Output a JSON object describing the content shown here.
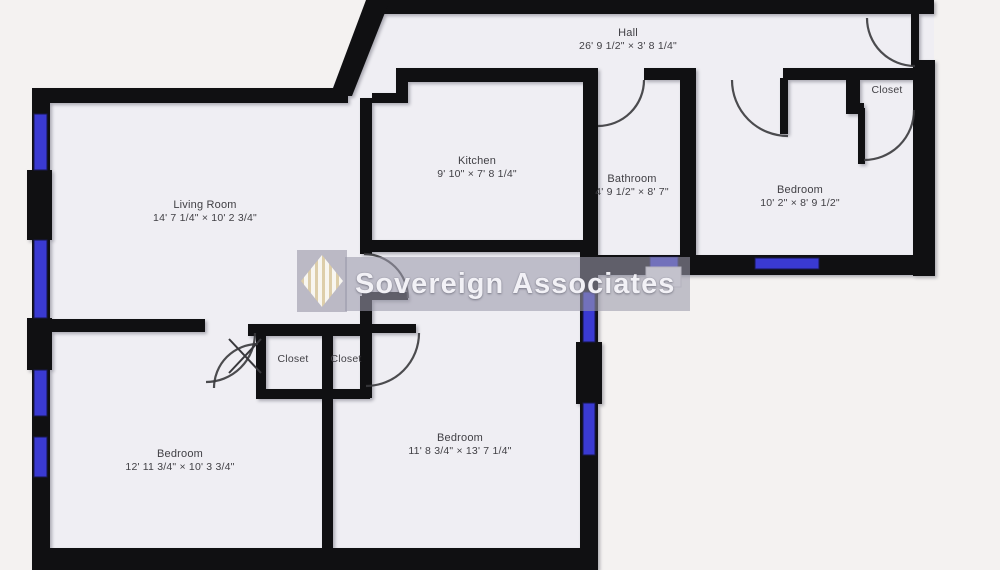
{
  "watermark": {
    "text": "Sovereign Associates",
    "logo_icon": "striped-diamond-logo"
  },
  "rooms": {
    "hall": {
      "name": "Hall",
      "dims": "26' 9 1/2\" × 3' 8 1/4\""
    },
    "kitchen": {
      "name": "Kitchen",
      "dims": "9' 10\" × 7' 8 1/4\""
    },
    "living_room": {
      "name": "Living Room",
      "dims": "14' 7 1/4\" × 10' 2 3/4\""
    },
    "bathroom": {
      "name": "Bathroom",
      "dims": "4' 9 1/2\" × 8' 7\""
    },
    "bedroom_ne": {
      "name": "Bedroom",
      "dims": "10' 2\" × 8' 9 1/2\""
    },
    "closet_ne": {
      "name": "Closet"
    },
    "closet_west": {
      "name": "Closet"
    },
    "closet_east": {
      "name": "Closet"
    },
    "bedroom_sw": {
      "name": "Bedroom",
      "dims": "12' 11 3/4\" × 10' 3 3/4\""
    },
    "bedroom_south": {
      "name": "Bedroom",
      "dims": "11' 8 3/4\" × 13' 7 1/4\""
    }
  },
  "colors": {
    "wall": "#101012",
    "window": "#3a3ad2",
    "room": "#efeef3",
    "bg": "#f4f2f1",
    "label": "#403f44",
    "arc": "#38383c",
    "band": "#9b9aab",
    "wmtext": "#f2f1f6",
    "gold": "#dfcfa8"
  }
}
